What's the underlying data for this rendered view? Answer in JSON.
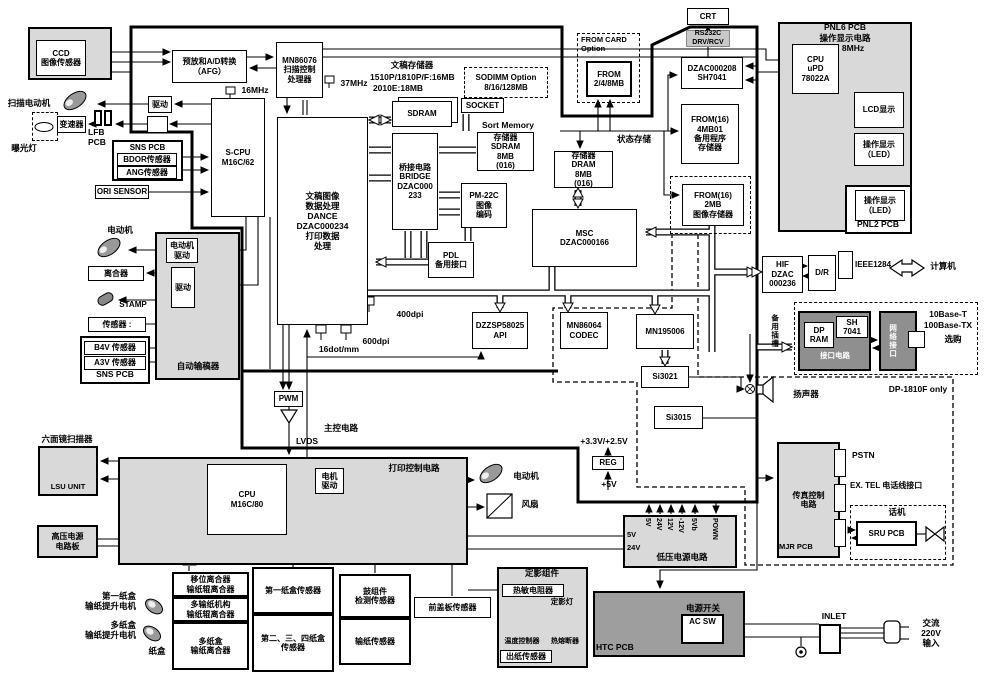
{
  "title": "DP-1510P/1810P/1810F/2010E 整机电路方框图",
  "colors": {
    "board_gray": "#d9d9d9",
    "dark_gray": "#8f8f8f",
    "htc_gray": "#9e9e9e",
    "line": "#000000",
    "background": "#ffffff",
    "small_label_bg": "#cccccc"
  },
  "blocks": {
    "ccd": "CCD\n图像传感器",
    "afg": "预放和A/D转换\n（AFG）",
    "mn86076": "MN86076\n扫描控制\n处理器",
    "scpu": "S-CPU\nM16C/62",
    "drive1": "驱动",
    "gearbox": "变速器",
    "sns_header": "SNS PCB",
    "bdor": "BDOR传感器",
    "ang": "ANG传感器",
    "ori": "ORI SENSOR",
    "motor_drive_adf": "电动机\n驱动",
    "drive_adf": "驱动",
    "clutch": "离合器",
    "sensors": "传感器 :",
    "b4v": "B4V 传感器",
    "a3v": "A3V 传感器",
    "sns_pcb2": "SNS PCB",
    "adf": "自动输稿器",
    "dance": "文稿图像\n数据处理\nDANCE\nDZAC000234\n打印数据\n处理",
    "sdram": "SDRAM",
    "sodimm": "SODIMM Option\n8/16/128MB",
    "socket": "SOCKET",
    "sort_sdram": "存储器\nSDRAM\n8MB\n(016)",
    "bridge": "桥接电路\nBRIDGE\nDZAC000\n233",
    "pm22c": "PM-22C\n图像\n编码",
    "pdl": "PDL\n备用接口",
    "msc": "MSC\nDZAC000166",
    "dram": "存储器\nDRAM\n8MB\n(016)",
    "fromcard": "FROM CARD\nOption",
    "from": "FROM\n2/4/8MB",
    "crt": "CRT",
    "rs232": "RS232C\nDRV/RCV",
    "dzac208": "DZAC000208\nSH7041",
    "from4": "FROM(16)\n4MB01\n备用程序\n存储器",
    "from2": "FROM(16)\n2MB\n图像存储器",
    "api": "DZZSP58025\nAPI",
    "codec": "MN86064\nCODEC",
    "mn195006": "MN195006",
    "si3021": "Si3021",
    "si3015": "Si3015",
    "hif": "HIF\nDZAC\n000236",
    "dr": "D/R",
    "dpram": "DP\nRAM",
    "sh7041": "SH\n7041",
    "iface": "接口电路",
    "network": "网络接口",
    "cpu_pnl": "CPU\nuPD\n78022A",
    "lcd": "LCD显示",
    "led1": "操作显示\n（LED）",
    "led2": "操作显示\n（LED）",
    "fax": "传真控制\n电路",
    "sru": "SRU PCB",
    "cpu_print": "CPU\nM16C/80",
    "mdrive": "电机\n驱动",
    "pwm": "PWM",
    "reg": "REG",
    "lsu": "LSU UNIT",
    "hv": "高压电源\n电路板",
    "clutch1": "移位离合器\n输纸辊离合器",
    "clutch2": "多输纸机构\n输纸辊离合器",
    "clutch3": "多纸盒\n输纸离合器",
    "cassette1_sensor": "第一纸盒传感器",
    "cassette234_sensor": "第二、三、四纸盒\n传感器",
    "drum_sensor": "鼓组件\n检测传感器",
    "feed_sensor": "输纸传感器",
    "cover_sensor": "前盖板传感器",
    "thermistor": "热敏电阻器",
    "exit_sensor": "出纸传感器",
    "acsw": "AC SW"
  },
  "labels": {
    "scan_motor": "扫描电动机",
    "exposure_lamp": "曝光灯",
    "lfb": "LFB\nPCB",
    "motor_adf": "电动机",
    "stamp": "STAMP",
    "freq16": "16MHz",
    "freq37": "37MHz",
    "freq8": "8MHz",
    "docmem_title": "文稿存储器",
    "docmem_l1": "1510P/1810P/F:16MB",
    "docmem_l2": "2010E:18MB",
    "sort_memory": "Sort Memory",
    "status_mem": "状态存储",
    "dpi400": "400dpi",
    "dpi600": "600dpi",
    "dot16": "16dot/mm",
    "lvds": "LVDS",
    "main_ctrl": "主控电路",
    "print_ctrl": "打印控制电路",
    "motor_print": "电动机",
    "fan": "风扇",
    "hex_scanner": "六面镜扫描器",
    "v33": "+3.3V/+2.5V",
    "v5": "+5V",
    "ieee": "IEEE1284",
    "computer": "计算机",
    "slot": "备用插槽",
    "tenbase1": "10Base-T",
    "tenbase2": "100Base-TX",
    "optional": "选购",
    "dp1810": "DP-1810F only",
    "speaker": "扬声器",
    "pstn": "PSTN",
    "extel": "EX. TEL 电话线接口",
    "phone": "话机",
    "mjr": "MJR PCB",
    "htc": "HTC PCB",
    "power_switch": "电源开关",
    "inlet": "INLET",
    "ac_in": "交流\n220V\n输入",
    "paper1_motor": "第一纸盒\n输纸提升电机",
    "paperm_motor": "多纸盒\n输纸提升电机",
    "cassette": "纸盒",
    "fuser_unit": "定影组件",
    "fuser_lamp": "定影灯",
    "temp_ctrl": "温度控制器",
    "thermal_fuse": "热熔断器",
    "pnl6": "PNL6 PCB",
    "pnl6_sub": "操作显示电路",
    "pnl2": "PNL2 PCB"
  },
  "power": {
    "title": "低压电源电路",
    "pins": [
      "5V",
      "24V",
      "12V",
      "-12V",
      "5Vb",
      "POWN"
    ],
    "left_pins": [
      "5V",
      "24V"
    ]
  }
}
